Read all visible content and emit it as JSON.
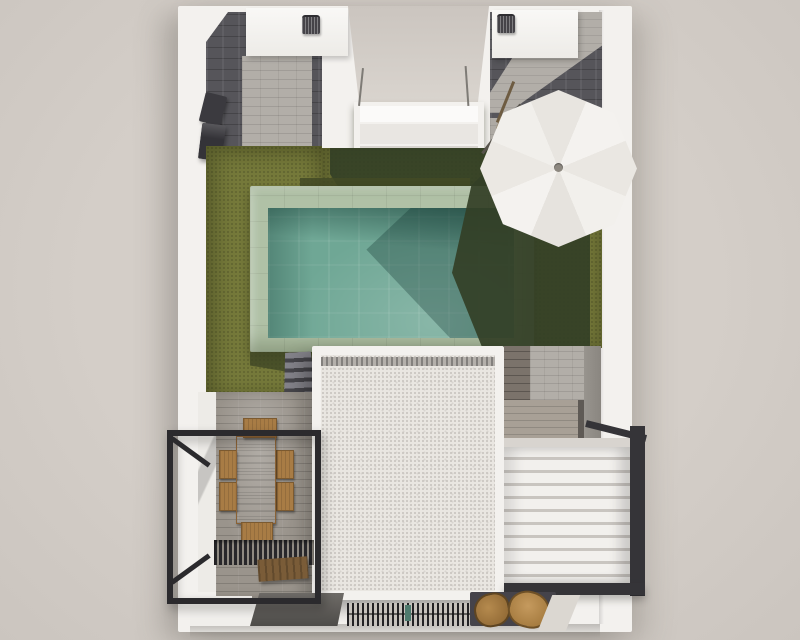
{
  "scene": {
    "type": "architectural-render-top-view",
    "subject": "Villa plot seen from directly above: swimming pool with stone surround on an olive lawn, white parasol, white gravel main roof, timber dining terrace with black railing frame, white louvered pergola, two roof boxes with barbecue grills, paved courtyards",
    "elements": [
      {
        "name": "plot-walls",
        "label": "white perimeter walls"
      },
      {
        "name": "left-courtyard",
        "label": "slate and stone paved courtyard, top left"
      },
      {
        "name": "right-courtyard",
        "label": "slate and stone paved courtyard, top right"
      },
      {
        "name": "rooftop-box-left",
        "label": "white roof box with grill"
      },
      {
        "name": "rooftop-box-right",
        "label": "white roof box with grill"
      },
      {
        "name": "balcony-recess",
        "label": "recessed white balcony between wings"
      },
      {
        "name": "lawn",
        "label": "olive green artificial lawn"
      },
      {
        "name": "swimming-pool",
        "label": "teal pool with pale sage stone deck"
      },
      {
        "name": "pool-steps",
        "label": "grey steps below pool deck"
      },
      {
        "name": "parasol",
        "label": "white octagonal parasol with cast shadow"
      },
      {
        "name": "main-roof",
        "label": "white gravel roof with parapet"
      },
      {
        "name": "dining-terrace",
        "label": "timber deck with wooden table and six chairs"
      },
      {
        "name": "railing-frame",
        "label": "black metal balcony railing frame"
      },
      {
        "name": "louvered-pergola",
        "label": "white louvered pergola with dark frame"
      },
      {
        "name": "deck-grate",
        "label": "dark slatted grate on terrace"
      },
      {
        "name": "bench",
        "label": "wooden bench"
      },
      {
        "name": "ac-unit",
        "label": "dark wall-mounted unit on left wall"
      },
      {
        "name": "bottom-vent",
        "label": "slatted vent strip at bottom wall"
      },
      {
        "name": "garden-chairs",
        "label": "round wooden chairs at bottom right"
      }
    ]
  },
  "palette": {
    "bg": "#d4cec8",
    "bg_edge": "#cbc5bf",
    "wall": "#f3f1ee",
    "wall_shadow": "#d8d4cf",
    "slate": "#56555a",
    "stone": "#b2aea8",
    "plank": "#9a948c",
    "plank_dark": "#7b736b",
    "grass": "#75793a",
    "grass_shadow": "#333f26",
    "deck": "#b0c1a6",
    "water": "#6fa795",
    "water_dark": "#2f5d52",
    "roof_border": "#f3f1ee",
    "roof_fill": "#e9e6e1",
    "roof_band": "#b4b0ab",
    "louver": "#f2f0ed",
    "louver_gap": "#c9c5c0",
    "frame": "#353438",
    "railing": "#2b2a2d",
    "wood": "#b98a50",
    "steel": "#3b3a3f",
    "umbrella": "#f3f1ee"
  }
}
